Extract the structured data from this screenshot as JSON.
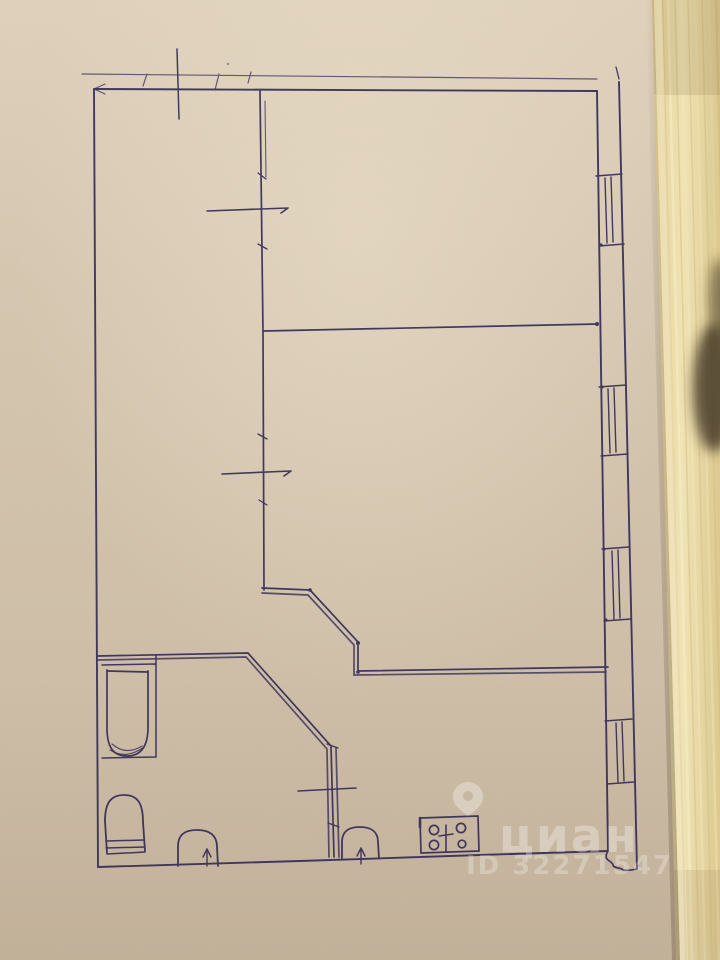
{
  "watermark": {
    "brand": "циан",
    "listing_id": "ID 32271547",
    "pin_icon": "location-pin-icon",
    "text_color": "#ffffff"
  },
  "sketch": {
    "type": "hand-drawn-floor-plan",
    "elements": [
      "outer-walls",
      "top-dimension-line",
      "interior-partition-walls",
      "door-opening-marks",
      "window-1",
      "window-2",
      "window-3",
      "window-4",
      "bathtub",
      "toilet",
      "entry-door-arch",
      "sink-arch",
      "stove-with-four-burners",
      "diagonal-hallway-walls",
      "door-swing-squiggle"
    ]
  },
  "palette": {
    "paper": "#d6c7b1",
    "paper_light": "#e4d6c1",
    "paper_dark": "#c2b098",
    "ink": "#352c58",
    "wood": "#e9d8a4",
    "wood_grain": "#d6c188",
    "dark_object": "#3e3322",
    "watermark": "#ffffff"
  }
}
